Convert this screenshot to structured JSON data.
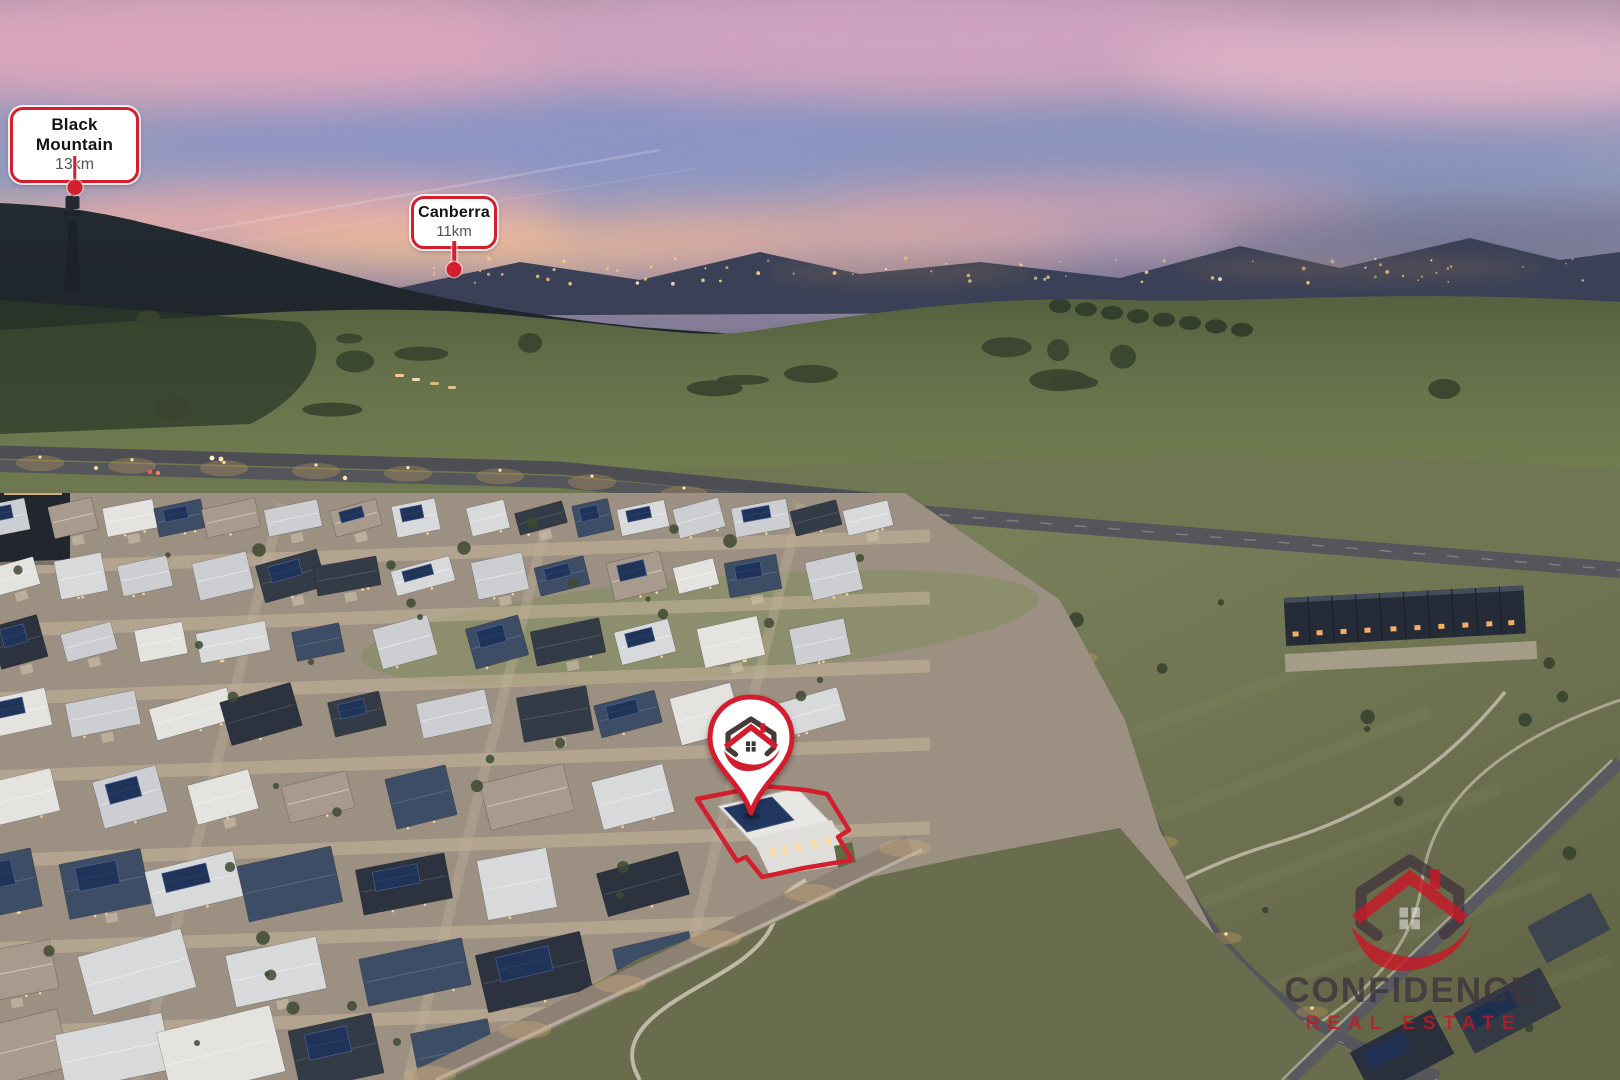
{
  "labels": {
    "black_mountain": {
      "name": "Black Mountain",
      "distance": "13km"
    },
    "canberra": {
      "name": "Canberra",
      "distance": "11km"
    }
  },
  "watermark": {
    "brand": "CONFIDENCE",
    "tagline": "REAL ESTATE"
  },
  "icons": {
    "pin": "location-pin-with-agency-logo",
    "logo": "confidence-real-estate-shield-logo"
  },
  "colors": {
    "accent_red": "#d31e2e",
    "label_name_text": "#141414",
    "label_distance_text": "#555555",
    "pin_fill": "#ffffff",
    "watermark_gray": "#42353e",
    "watermark_red": "#ca1725"
  }
}
